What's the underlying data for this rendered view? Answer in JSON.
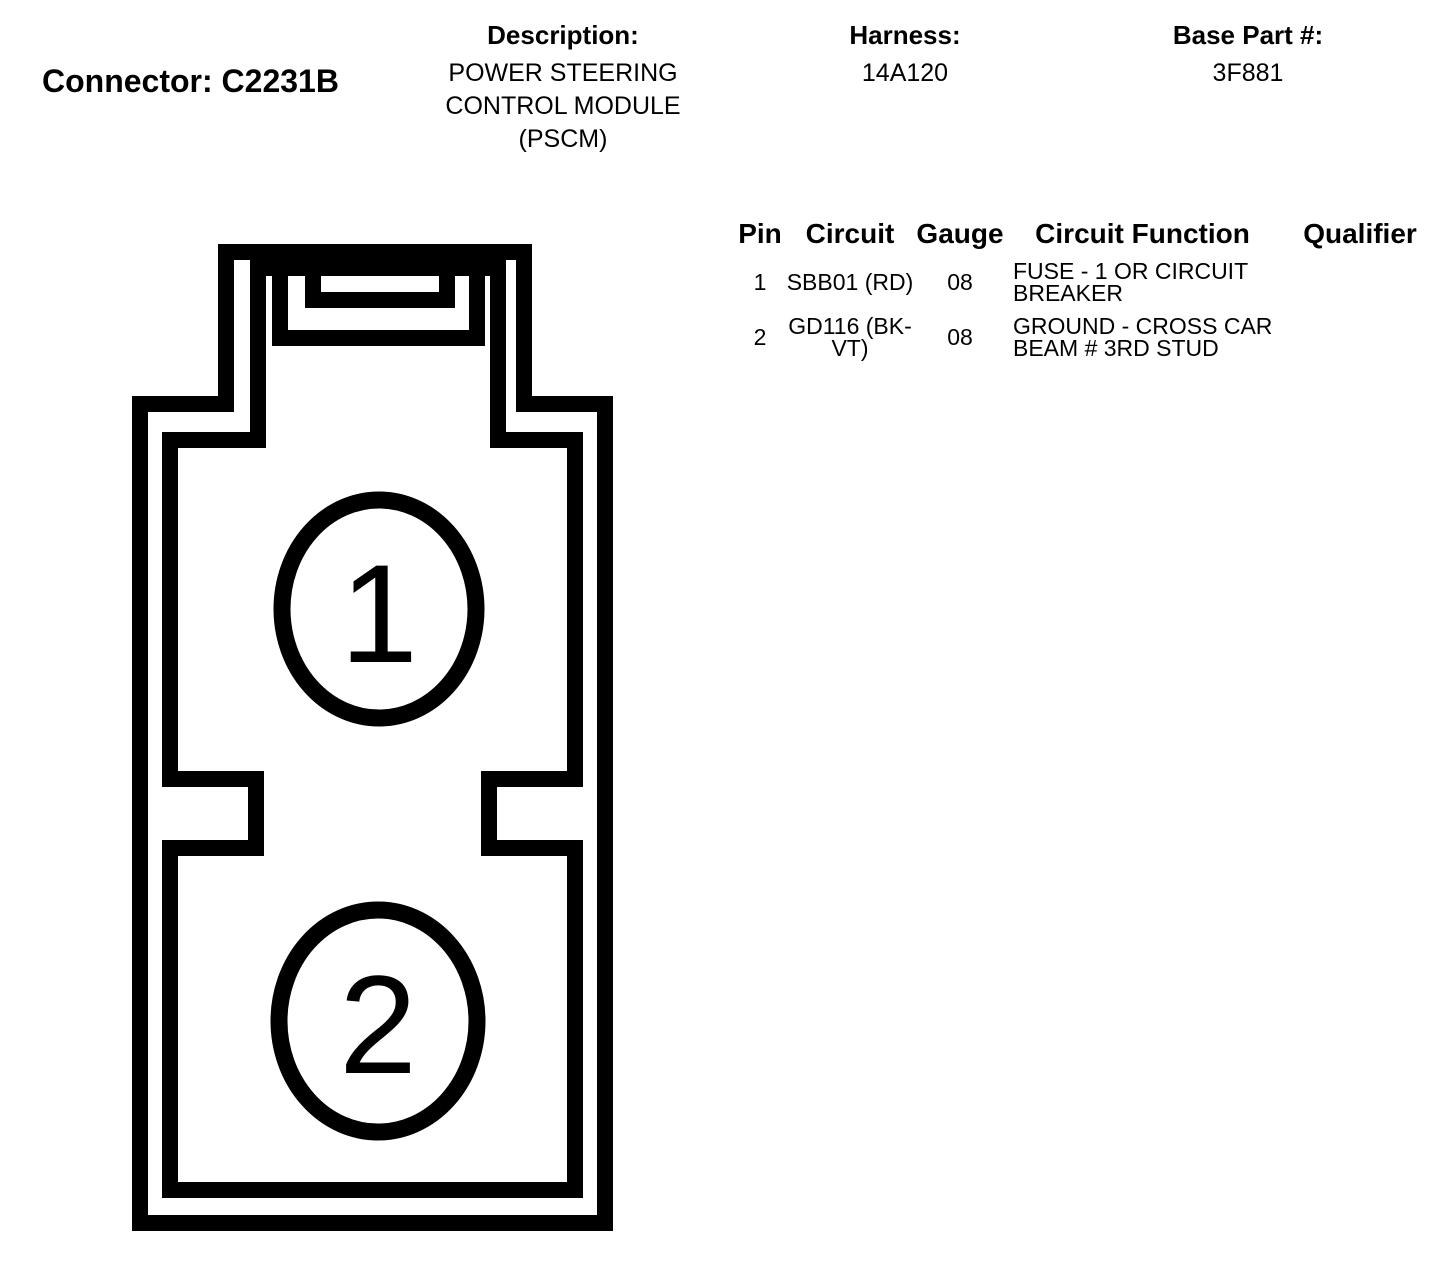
{
  "colors": {
    "background": "#ffffff",
    "text": "#000000",
    "line": "#000000"
  },
  "header": {
    "connector_label": "Connector: C2231B",
    "description": {
      "label": "Description:",
      "value": "POWER STEERING CONTROL MODULE (PSCM)"
    },
    "harness": {
      "label": "Harness:",
      "value": "14A120"
    },
    "base_part": {
      "label": "Base Part #:",
      "value": "3F881"
    }
  },
  "pin_table": {
    "columns": [
      "Pin",
      "Circuit",
      "Gauge",
      "Circuit Function",
      "Qualifier"
    ],
    "rows": [
      {
        "pin": "1",
        "circuit": "SBB01 (RD)",
        "gauge": "08",
        "circuit_function": "FUSE - 1 OR CIRCUIT BREAKER",
        "qualifier": ""
      },
      {
        "pin": "2",
        "circuit": "GD116 (BK-VT)",
        "gauge": "08",
        "circuit_function": "GROUND - CROSS CAR BEAM # 3RD STUD",
        "qualifier": ""
      }
    ]
  },
  "connector_view": {
    "pins": [
      {
        "number": "1"
      },
      {
        "number": "2"
      }
    ]
  }
}
